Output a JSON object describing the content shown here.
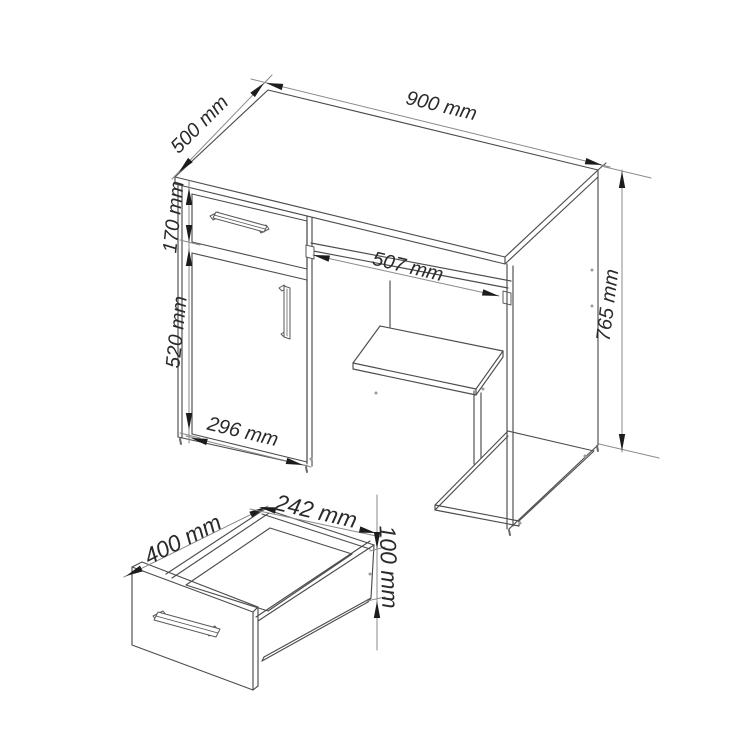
{
  "drawing": {
    "type": "furniture-dimension-diagram",
    "background_color": "#ffffff",
    "line_color": "#4d4d4d",
    "dimension_line_color": "#8a8a8a",
    "arrow_color": "#1c1c1c",
    "text_color": "#2a2a2a"
  },
  "desk": {
    "width_label": "900 mm",
    "depth_label": "500 mm",
    "drawer_height_label": "170 mm",
    "door_height_label": "520 mm",
    "door_width_label": "296 mm",
    "tray_width_label": "507 mm",
    "height_label": "765 mm"
  },
  "drawer_detail": {
    "depth_label": "400 mm",
    "width_label": "242 mm",
    "height_label": "100 mm"
  }
}
